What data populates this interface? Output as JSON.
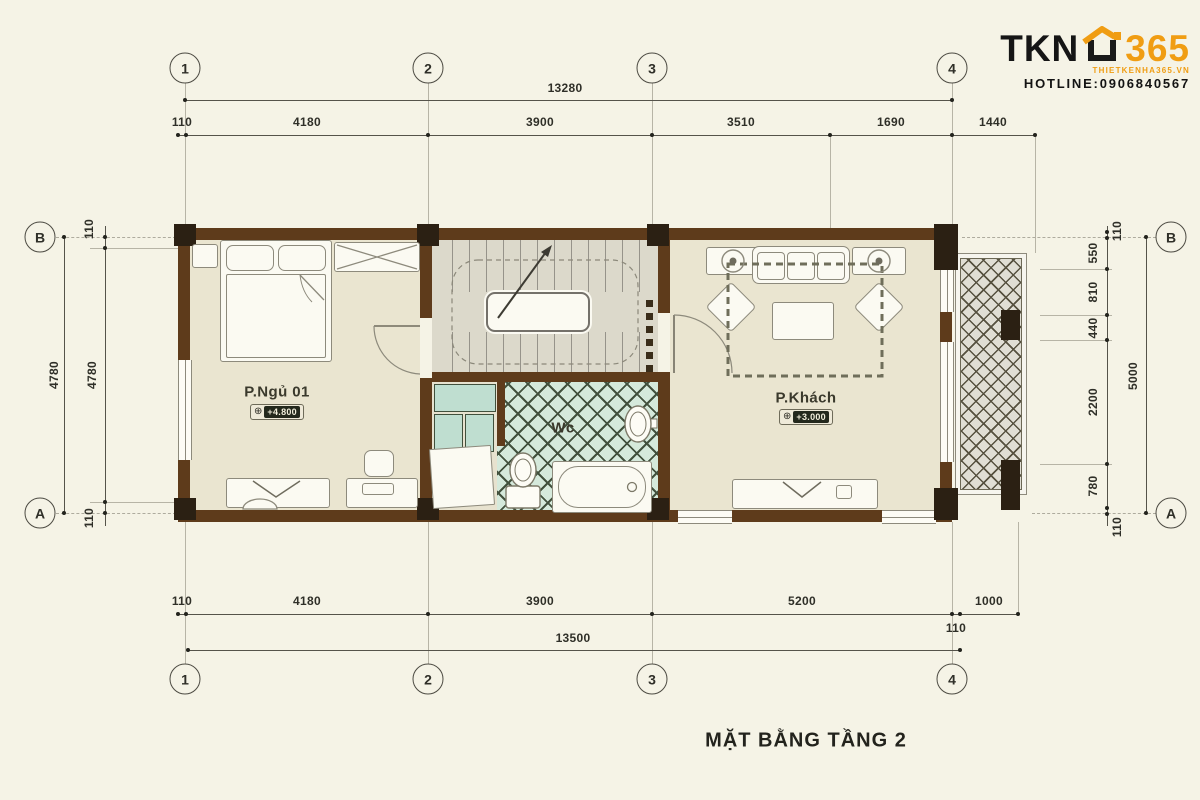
{
  "logo": {
    "brand": "TKN",
    "number": "365",
    "website": "THIETKENHA365.VN",
    "hotline": "HOTLINE:0906840567"
  },
  "title": "MẶT BẰNG TẦNG 2",
  "grid": {
    "columns": [
      "1",
      "2",
      "3",
      "4"
    ],
    "rows": [
      "B",
      "A"
    ]
  },
  "dims": {
    "top_total": "13280",
    "top_row": [
      "110",
      "4180",
      "3900",
      "3510",
      "1690",
      "1440"
    ],
    "bottom_row": [
      "110",
      "4180",
      "3900",
      "5200",
      "110",
      "1000"
    ],
    "bottom_total": "13500",
    "left": {
      "outer": "4780",
      "inner": "4780",
      "top": "110",
      "bottom": "110"
    },
    "right": {
      "segments": [
        "110",
        "550",
        "810",
        "440",
        "2200",
        "780",
        "110"
      ],
      "total": "5000"
    }
  },
  "rooms": {
    "bedroom": {
      "label": "P.Ngủ 01",
      "level": "+4.800"
    },
    "wc": {
      "label": "Wc"
    },
    "living": {
      "label": "P.Khách",
      "level": "+3.000"
    }
  },
  "icons": {
    "level": "⊕"
  },
  "colors": {
    "wall": "#5e3b1b",
    "accent": "#f09d13",
    "floor": "#eae5d0",
    "tile": "#d5e9db"
  }
}
